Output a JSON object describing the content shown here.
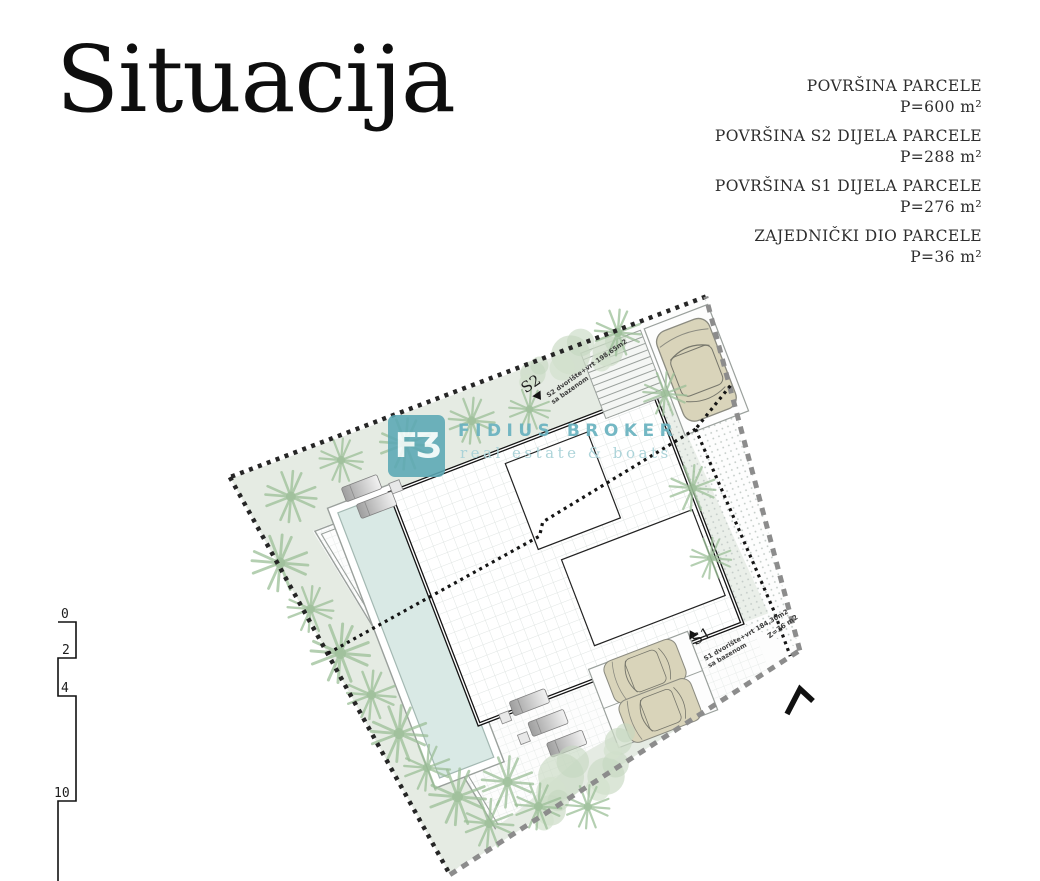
{
  "page": {
    "title": "Situacija"
  },
  "areas": [
    {
      "label": "POVRŠINA PARCELE",
      "value": "P=600 m²"
    },
    {
      "label": "POVRŠINA S2 DIJELA PARCELE",
      "value": "P=288 m²"
    },
    {
      "label": "POVRŠINA S1 DIJELA PARCELE",
      "value": "P=276 m²"
    },
    {
      "label": "ZAJEDNIČKI DIO PARCELE",
      "value": "P=36 m²"
    }
  ],
  "watermark": {
    "logo": "FƷ",
    "name": "FIDIUS BROKER",
    "tagline": "real estate & boats",
    "accent": "#69b2c0",
    "accent_light": "#a9d2d8",
    "logo_bg": "#5ba8b5"
  },
  "plan": {
    "s2_marker": "S2",
    "s1_marker": "S1",
    "s2_note_line1": "S2 dvorište+vrt 198,65m2",
    "s2_note_line2": "sa bazenom",
    "s1_note_line1": "S1 dvorište+vrt 184,30m2",
    "s1_note_line2": "sa bazenom",
    "z_note": "Z=36 m2"
  },
  "scale_bar": {
    "ticks": [
      "0",
      "2",
      "4",
      "10"
    ]
  },
  "colors": {
    "green_band": "#e5ebe3",
    "palm": "#9cbf98",
    "round_tree": "#ccdcc6",
    "pool_water": "#d9e9e5",
    "pool_edge": "#a3b8b2",
    "grid_line": "#e0e5e3",
    "dot_texture": "#c4ccc8",
    "wall_black": "#141414",
    "boundary_black": "#262626",
    "boundary_gray": "#8c8c8c",
    "deck_edge": "#9aa09c",
    "car_body": "#d9d4ba"
  }
}
